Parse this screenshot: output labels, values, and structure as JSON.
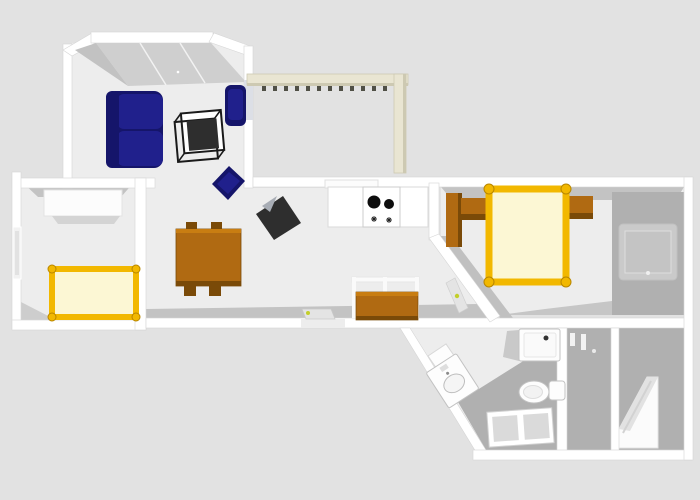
{
  "scene": {
    "type": "floor-plan-3d-render",
    "view": "top-down",
    "visible_text": ""
  },
  "colors": {
    "background": "#e2e2e2",
    "wall": "#ffffff",
    "wall_edge": "#d6d6d6",
    "floor": "#ededed",
    "floor_shadow": "#c3c3c3",
    "floor_dark": "#b0b0b0",
    "slab": "#cfcfcf",
    "slab_dark": "#c2c2c2",
    "sofa_navy": "#20208c",
    "sofa_navy_dark": "#15156a",
    "sofa_navy_light": "#2d2ea6",
    "wood": "#b06a12",
    "wood_light": "#c87d12",
    "wood_dark": "#7a4a08",
    "bed_frame": "#f2b800",
    "bed_frame_dark": "#b88600",
    "mattress": "#fcf7d4",
    "beam": "#e9e5d2",
    "beam_dark": "#cdc9b2",
    "dentil": "#4f4f45",
    "tv_dark": "#2e2e2e",
    "tv_light": "#a8adb5",
    "burner": "#0d0d0d",
    "fixture": "#fdfdfd",
    "fixture_edge": "#c2c2c2",
    "door_leaf": "#e4e4e4",
    "handle": "#c3cf2a",
    "window_glass": "#dcdfe6",
    "window_dark": "#cacaca"
  },
  "floor_plan": {
    "rooms": [
      {
        "name": "living-room",
        "position": "top-left",
        "furniture": [
          "sofa",
          "coffee-table",
          "armchair",
          "floor-cushion-chair",
          "tv-unit",
          "sloped-ceiling-panel",
          "window-east"
        ]
      },
      {
        "name": "bedroom-small",
        "position": "middle-left",
        "furniture": [
          "white-wardrobe",
          "single-bed",
          "window-west"
        ]
      },
      {
        "name": "kitchen-dining",
        "position": "center",
        "furniture": [
          "dining-table-with-chairs",
          "kitchen-counter",
          "stove-cooktop",
          "cooker-hood",
          "sideboard",
          "pass-through-window",
          "entrance-door"
        ]
      },
      {
        "name": "bedroom-large",
        "position": "center-right",
        "furniture": [
          "double-bed",
          "nightstand-left",
          "nightstand-right",
          "brown-wardrobe",
          "window-east",
          "door-on-diagonal-wall"
        ]
      },
      {
        "name": "bathroom",
        "position": "bottom-center",
        "furniture": [
          "shower-tray",
          "toilet",
          "washbasin",
          "floor-grate"
        ]
      },
      {
        "name": "niche",
        "position": "bottom-right-inner",
        "furniture": [
          "wall-accessories"
        ]
      },
      {
        "name": "corner-room",
        "position": "bottom-right",
        "furniture": [
          "corner-steps"
        ]
      },
      {
        "name": "balcony-pergola",
        "position": "top-right",
        "furniture": [
          "beam-horizontal",
          "beam-vertical",
          "dentils"
        ]
      }
    ]
  }
}
